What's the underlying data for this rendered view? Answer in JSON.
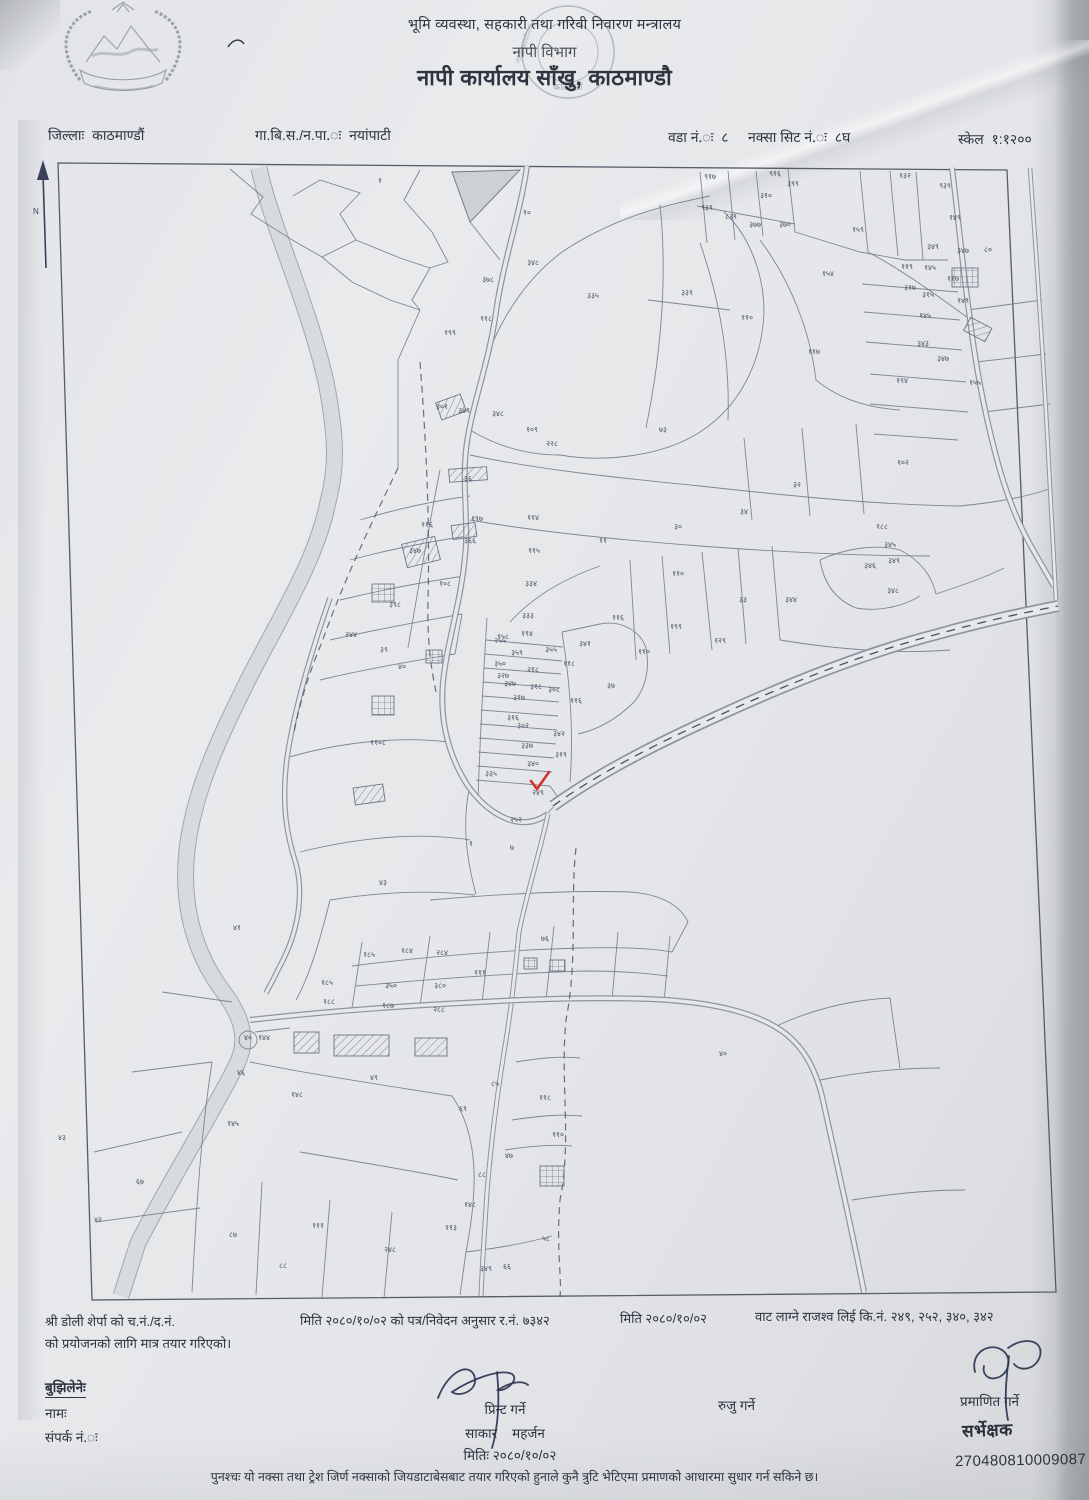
{
  "header": {
    "ministry": "भूमि व्यवस्था, सहकारी तथा गरिवी निवारण मन्त्रालय",
    "department": "नापी विभाग",
    "office": "नापी कार्यालय साँखु, काठमाण्डौ",
    "stamp_bottom": "काठमाडौं",
    "stamp_mid": "नापी कार्यालय"
  },
  "meta": {
    "district_label": "जिल्लाः",
    "district": "काठमाण्डौं",
    "vdc_label": "गा.बि.स./न.पा.ः",
    "vdc": "नयांपाटी",
    "ward_label": "वडा नं.ः",
    "ward": "८",
    "sheet_label": "नक्सा सिट नं.ः",
    "sheet": "८घ",
    "scale_label": "स्केल",
    "scale": "१:१२००"
  },
  "map": {
    "north_label": "N",
    "check_color": "#cf3333",
    "parcels": [
      {
        "n": "१",
        "x": 380,
        "y": 183
      },
      {
        "n": "१०",
        "x": 527,
        "y": 215
      },
      {
        "n": "९१७",
        "x": 710,
        "y": 179
      },
      {
        "n": "९१६",
        "x": 775,
        "y": 176
      },
      {
        "n": "३९९",
        "x": 793,
        "y": 186
      },
      {
        "n": "३१०",
        "x": 766,
        "y": 198
      },
      {
        "n": "९३९",
        "x": 707,
        "y": 210
      },
      {
        "n": "८३९",
        "x": 731,
        "y": 219
      },
      {
        "n": "३७७",
        "x": 755,
        "y": 227
      },
      {
        "n": "३७०",
        "x": 785,
        "y": 227
      },
      {
        "n": "१५९",
        "x": 858,
        "y": 232
      },
      {
        "n": "१३२",
        "x": 905,
        "y": 178
      },
      {
        "n": "९३९",
        "x": 945,
        "y": 188
      },
      {
        "n": "१४९",
        "x": 955,
        "y": 220
      },
      {
        "n": "१५४",
        "x": 828,
        "y": 276
      },
      {
        "n": "३३९",
        "x": 687,
        "y": 295
      },
      {
        "n": "३३५",
        "x": 593,
        "y": 298
      },
      {
        "n": "११९",
        "x": 907,
        "y": 269
      },
      {
        "n": "३१७",
        "x": 910,
        "y": 290
      },
      {
        "n": "३४९",
        "x": 933,
        "y": 249
      },
      {
        "n": "३४७",
        "x": 963,
        "y": 253
      },
      {
        "n": "८०",
        "x": 988,
        "y": 252
      },
      {
        "n": "१४५",
        "x": 930,
        "y": 270
      },
      {
        "n": "११७",
        "x": 953,
        "y": 281
      },
      {
        "n": "३१५",
        "x": 928,
        "y": 297
      },
      {
        "n": "१४९",
        "x": 963,
        "y": 303
      },
      {
        "n": "१४५",
        "x": 925,
        "y": 318
      },
      {
        "n": "३४३",
        "x": 923,
        "y": 346
      },
      {
        "n": "३४७",
        "x": 943,
        "y": 361
      },
      {
        "n": "१९४",
        "x": 902,
        "y": 383
      },
      {
        "n": "१५५",
        "x": 975,
        "y": 385
      },
      {
        "n": "१०२",
        "x": 903,
        "y": 465
      },
      {
        "n": "३४८",
        "x": 533,
        "y": 265
      },
      {
        "n": "३७८",
        "x": 488,
        "y": 282
      },
      {
        "n": "११८",
        "x": 486,
        "y": 321
      },
      {
        "n": "१९९",
        "x": 450,
        "y": 335
      },
      {
        "n": "११०",
        "x": 747,
        "y": 320
      },
      {
        "n": "११७",
        "x": 814,
        "y": 354
      },
      {
        "n": "३०१",
        "x": 442,
        "y": 409
      },
      {
        "n": "३४९",
        "x": 464,
        "y": 413
      },
      {
        "n": "३४८",
        "x": 498,
        "y": 416
      },
      {
        "n": "१०९",
        "x": 532,
        "y": 432
      },
      {
        "n": "२२८",
        "x": 552,
        "y": 446
      },
      {
        "n": "७३",
        "x": 663,
        "y": 432
      },
      {
        "n": "३६",
        "x": 468,
        "y": 481
      },
      {
        "n": "१९७",
        "x": 477,
        "y": 521
      },
      {
        "n": "३६६",
        "x": 470,
        "y": 543
      },
      {
        "n": "११६",
        "x": 427,
        "y": 527
      },
      {
        "n": "३४७",
        "x": 415,
        "y": 553
      },
      {
        "n": "१०८",
        "x": 445,
        "y": 586
      },
      {
        "n": "३९८",
        "x": 395,
        "y": 607
      },
      {
        "n": "२४४",
        "x": 351,
        "y": 637
      },
      {
        "n": "३९",
        "x": 384,
        "y": 652
      },
      {
        "n": "४०",
        "x": 402,
        "y": 669
      },
      {
        "n": "११४",
        "x": 533,
        "y": 520
      },
      {
        "n": "११५",
        "x": 534,
        "y": 553
      },
      {
        "n": "३३४",
        "x": 531,
        "y": 586
      },
      {
        "n": "३३३",
        "x": 528,
        "y": 618
      },
      {
        "n": "१५८",
        "x": 503,
        "y": 639
      },
      {
        "n": "११",
        "x": 603,
        "y": 543
      },
      {
        "n": "३०",
        "x": 678,
        "y": 529
      },
      {
        "n": "३४",
        "x": 744,
        "y": 514
      },
      {
        "n": "३२",
        "x": 797,
        "y": 487
      },
      {
        "n": "१८८",
        "x": 882,
        "y": 529
      },
      {
        "n": "३४५",
        "x": 890,
        "y": 547
      },
      {
        "n": "३४९",
        "x": 894,
        "y": 563
      },
      {
        "n": "३४६",
        "x": 870,
        "y": 568
      },
      {
        "n": "३४८",
        "x": 893,
        "y": 593
      },
      {
        "n": "११०",
        "x": 678,
        "y": 576
      },
      {
        "n": "११६",
        "x": 618,
        "y": 620
      },
      {
        "n": "१९९",
        "x": 676,
        "y": 629
      },
      {
        "n": "१२९",
        "x": 720,
        "y": 643
      },
      {
        "n": "११०",
        "x": 644,
        "y": 654
      },
      {
        "n": "३३",
        "x": 743,
        "y": 602
      },
      {
        "n": "३४४",
        "x": 791,
        "y": 602
      },
      {
        "n": "११०८",
        "x": 378,
        "y": 745
      },
      {
        "n": "१९४",
        "x": 527,
        "y": 636
      },
      {
        "n": "२५५",
        "x": 500,
        "y": 643
      },
      {
        "n": "३५५",
        "x": 551,
        "y": 652
      },
      {
        "n": "३५९",
        "x": 517,
        "y": 655
      },
      {
        "n": "३५०",
        "x": 500,
        "y": 666
      },
      {
        "n": "३४१",
        "x": 585,
        "y": 646
      },
      {
        "n": "११८",
        "x": 569,
        "y": 666
      },
      {
        "n": "२१८",
        "x": 533,
        "y": 672
      },
      {
        "n": "३२७",
        "x": 503,
        "y": 678
      },
      {
        "n": "३४७",
        "x": 510,
        "y": 686
      },
      {
        "n": "३१८",
        "x": 536,
        "y": 689
      },
      {
        "n": "३०८",
        "x": 554,
        "y": 692
      },
      {
        "n": "११६",
        "x": 576,
        "y": 703
      },
      {
        "n": "३७",
        "x": 611,
        "y": 688
      },
      {
        "n": "३१७",
        "x": 519,
        "y": 700
      },
      {
        "n": "३१६",
        "x": 513,
        "y": 720
      },
      {
        "n": "३०२",
        "x": 523,
        "y": 728
      },
      {
        "n": "३४२",
        "x": 559,
        "y": 736
      },
      {
        "n": "३३७",
        "x": 527,
        "y": 748
      },
      {
        "n": "३१९",
        "x": 561,
        "y": 757
      },
      {
        "n": "३४०",
        "x": 533,
        "y": 766
      },
      {
        "n": "३३५",
        "x": 491,
        "y": 776
      },
      {
        "n": "२४९",
        "x": 538,
        "y": 795
      },
      {
        "n": "२५२",
        "x": 516,
        "y": 822
      },
      {
        "n": "४३",
        "x": 383,
        "y": 885
      },
      {
        "n": "१",
        "x": 471,
        "y": 846
      },
      {
        "n": "७",
        "x": 512,
        "y": 850
      },
      {
        "n": "४१",
        "x": 237,
        "y": 930
      },
      {
        "n": "७६",
        "x": 545,
        "y": 941
      },
      {
        "n": "१८५",
        "x": 369,
        "y": 957
      },
      {
        "n": "१८४",
        "x": 407,
        "y": 953
      },
      {
        "n": "२८४",
        "x": 442,
        "y": 955
      },
      {
        "n": "१११",
        "x": 480,
        "y": 975
      },
      {
        "n": "१८५",
        "x": 327,
        "y": 985
      },
      {
        "n": "३५०",
        "x": 391,
        "y": 988
      },
      {
        "n": "३८०",
        "x": 440,
        "y": 988
      },
      {
        "n": "१८८",
        "x": 329,
        "y": 1004
      },
      {
        "n": "१८७",
        "x": 388,
        "y": 1008
      },
      {
        "n": "२८८",
        "x": 439,
        "y": 1012
      },
      {
        "n": "४०",
        "x": 248,
        "y": 1040
      },
      {
        "n": "१४४",
        "x": 264,
        "y": 1040
      },
      {
        "n": "४६",
        "x": 241,
        "y": 1075
      },
      {
        "n": "१४८",
        "x": 297,
        "y": 1097
      },
      {
        "n": "४९",
        "x": 374,
        "y": 1080
      },
      {
        "n": "८५",
        "x": 495,
        "y": 1086
      },
      {
        "n": "११८",
        "x": 545,
        "y": 1100
      },
      {
        "n": "११०",
        "x": 558,
        "y": 1137
      },
      {
        "n": "४७",
        "x": 509,
        "y": 1158
      },
      {
        "n": "८८",
        "x": 482,
        "y": 1177
      },
      {
        "n": "१४८",
        "x": 470,
        "y": 1207
      },
      {
        "n": "११३",
        "x": 451,
        "y": 1230
      },
      {
        "n": "५८",
        "x": 546,
        "y": 1241
      },
      {
        "n": "३४९",
        "x": 486,
        "y": 1271
      },
      {
        "n": "६६",
        "x": 507,
        "y": 1269
      },
      {
        "n": "१४५",
        "x": 233,
        "y": 1126
      },
      {
        "n": "४३",
        "x": 62,
        "y": 1140
      },
      {
        "n": "४२",
        "x": 98,
        "y": 1222
      },
      {
        "n": "८८",
        "x": 283,
        "y": 1268
      },
      {
        "n": "१११",
        "x": 318,
        "y": 1228
      },
      {
        "n": "२४८",
        "x": 390,
        "y": 1252
      },
      {
        "n": "६७",
        "x": 140,
        "y": 1184
      },
      {
        "n": "८७",
        "x": 233,
        "y": 1237
      },
      {
        "n": "४०",
        "x": 723,
        "y": 1056
      },
      {
        "n": "६९",
        "x": 463,
        "y": 1111
      }
    ]
  },
  "notes": {
    "seg1": "श्री   डोली शेर्पा   को च.नं./द.नं.",
    "seg2": "मिति २०८०/१०/०२ को पत्र/निवेदन अनुसार र.नं.  ७३४२",
    "seg3": "मिति २०८०/१०/०२",
    "seg4": "वाट लाग्ने राजश्व लिई कि.नं. २४९, २५२, ३४०, ३४२",
    "line2": "को प्रयोजनको लागि मात्र तयार गरिएको।"
  },
  "signatures": {
    "receiver_heading": "बुझिलेनेः",
    "name_label": "नामः",
    "contact_label": "संपर्क नं.ः",
    "print_label": "प्रिन्ट गर्ने",
    "printer_name_left": "साकार",
    "printer_name_right": "महर्जन",
    "print_date": "मितिः २०८०/१०/०२",
    "check_label": "रुजु गर्ने",
    "certify_label": "प्रमाणित गर्ने",
    "certifier_stamp": "सर्भेक्षक",
    "barcode_number": "270480810009087"
  },
  "footer": {
    "note": "पुनश्चः यो नक्सा तथा ट्रेश जिर्ण नक्साको जियडाटाबेसबाट तयार गरिएको हुनाले कुनै त्रुटि भेटिएमा प्रमाणको आधारमा सुधार गर्न सकिने छ।"
  }
}
